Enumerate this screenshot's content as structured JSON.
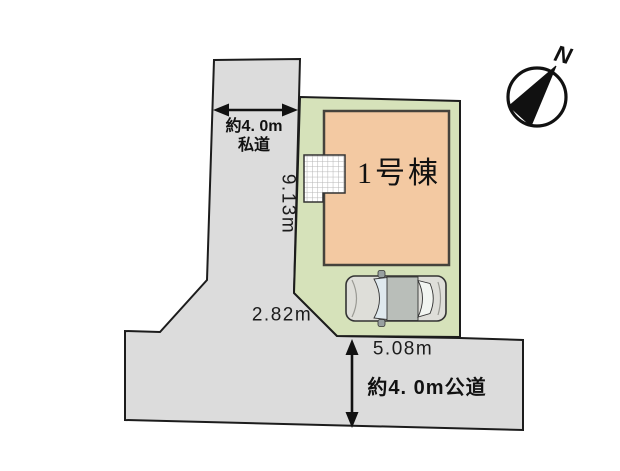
{
  "plan": {
    "building": {
      "label": "1号棟"
    },
    "private_road": {
      "width_label": "約4. 0m",
      "type_label": "私道",
      "frontage_dim": "9.13m"
    },
    "public_road": {
      "label": "約4. 0m公道",
      "frontage_dim": "5.08m"
    },
    "southwest_edge_dim": "2.82m",
    "compass": {
      "north_label": "N"
    }
  },
  "colors": {
    "road-fill": "#dcdcdc",
    "lot-fill": "#d6e2ba",
    "building-fill": "#f3c9a2",
    "outline": "#1c1c1c",
    "building-outline": "#45423c",
    "car-body": "#dedeD9",
    "car-roof": "#b9beb9",
    "car-glass": "#dfe9ee",
    "grid-line": "#b5b5b5"
  }
}
